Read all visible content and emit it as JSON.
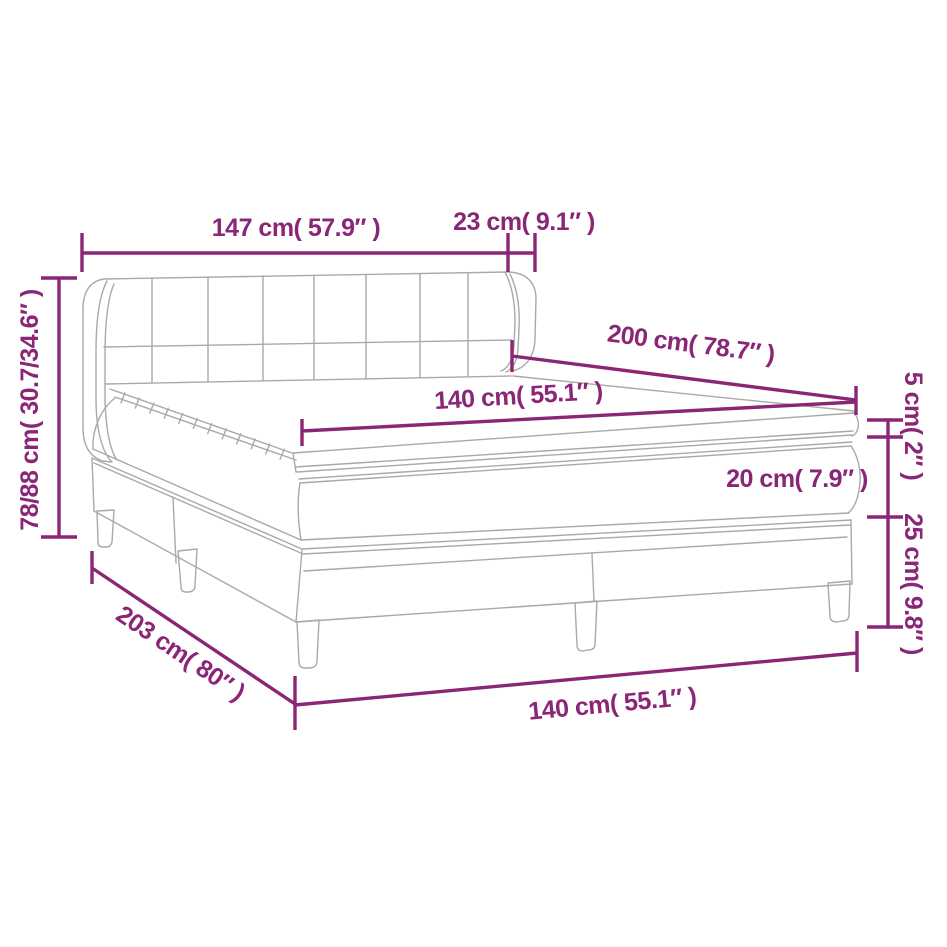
{
  "diagram": {
    "type": "bed-dimension-diagram",
    "colors": {
      "dimension_color": "#8b2576",
      "outline_color": "#a9a9a9",
      "background": "#ffffff"
    },
    "labels": {
      "headboard_total_width": "147 cm( 57.9″ )",
      "headboard_side_depth": "23 cm( 9.1″ )",
      "headboard_height_range": "78/88 cm( 30.7/34.6″ )",
      "bed_length": "200 cm( 78.7″ )",
      "mattress_width": "140 cm( 55.1″ )",
      "topper_thickness": "5 cm( 2″ )",
      "mattress_thickness": "20 cm( 7.9″ )",
      "base_height": "25 cm( 9.8″ )",
      "frame_length": "203 cm( 80″ )",
      "frame_width": "140 cm( 55.1″ )"
    }
  }
}
